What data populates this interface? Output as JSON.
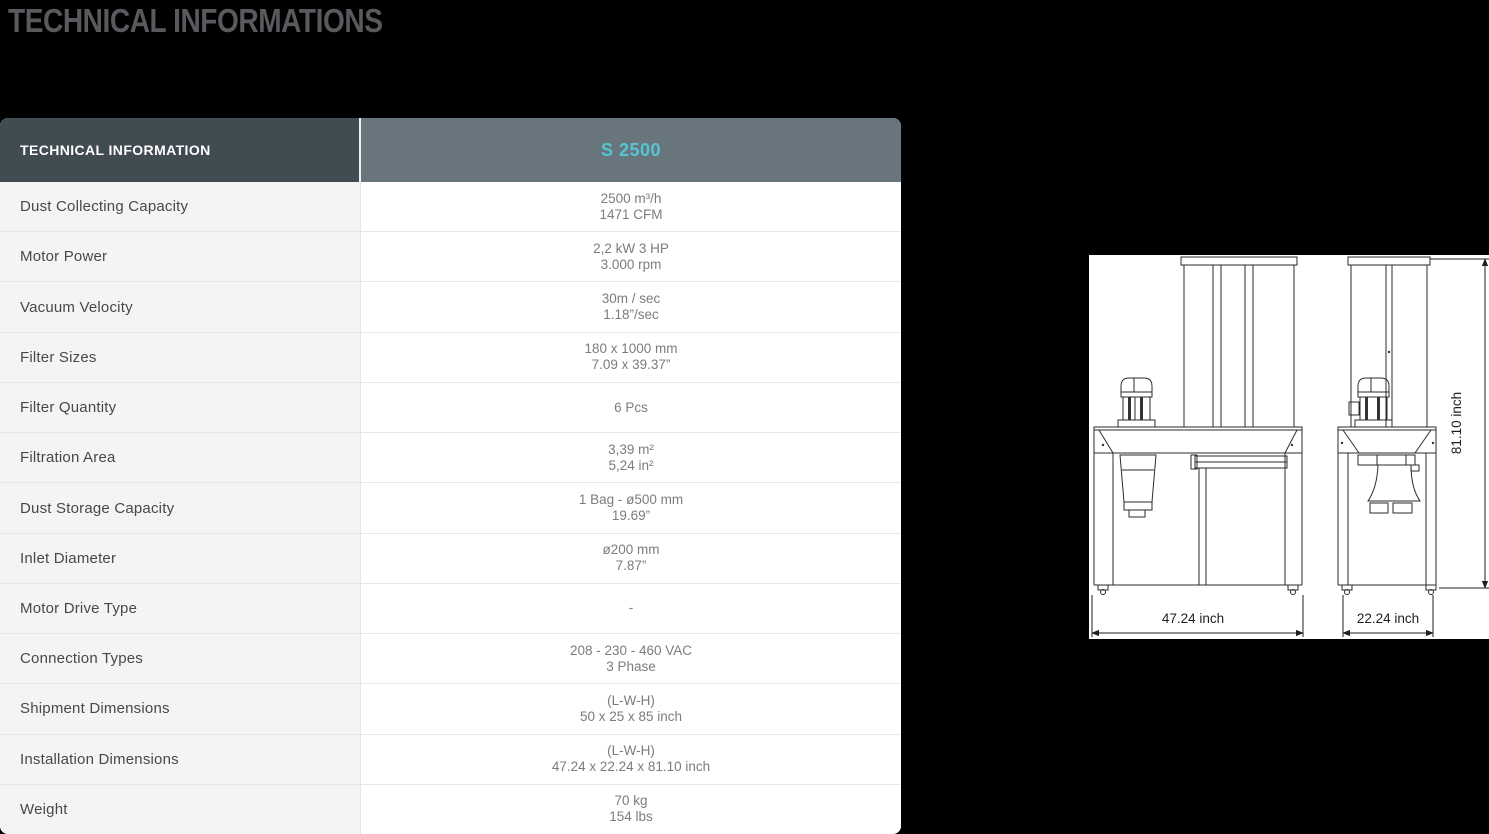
{
  "page": {
    "title": "TECHNICAL INFORMATIONS",
    "background": "#000000"
  },
  "table": {
    "header": {
      "left": "TECHNICAL INFORMATION",
      "right": "S 2500"
    },
    "rows": [
      {
        "label": "Dust Collecting Capacity",
        "value1": "2500 m³/h",
        "value2": "1471 CFM"
      },
      {
        "label": "Motor Power",
        "value1": "2,2 kW 3 HP",
        "value2": "3.000 rpm"
      },
      {
        "label": "Vacuum Velocity",
        "value1": "30m / sec",
        "value2": "1.18”/sec"
      },
      {
        "label": "Filter Sizes",
        "value1": "180 x 1000 mm",
        "value2": "7.09 x 39.37”"
      },
      {
        "label": "Filter Quantity",
        "value1": "6 Pcs",
        "value2": ""
      },
      {
        "label": "Filtration Area",
        "value1": "3,39 m²",
        "value2": "5,24 in²"
      },
      {
        "label": "Dust Storage Capacity",
        "value1": "1 Bag - ø500 mm",
        "value2": "19.69”"
      },
      {
        "label": "Inlet Diameter",
        "value1": "ø200 mm",
        "value2": "7.87”"
      },
      {
        "label": "Motor Drive Type",
        "value1": "-",
        "value2": ""
      },
      {
        "label": "Connection Types",
        "value1": "208 - 230 - 460 VAC",
        "value2": "3 Phase"
      },
      {
        "label": "Shipment Dimensions",
        "value1": "(L-W-H)",
        "value2": "50 x 25 x 85 inch"
      },
      {
        "label": "Installation Dimensions",
        "value1": "(L-W-H)",
        "value2": "47.24 x 22.24 x 81.10 inch"
      },
      {
        "label": "Weight",
        "value1": "70 kg",
        "value2": "154 lbs"
      }
    ]
  },
  "drawing": {
    "front_width_label": "47.24 inch",
    "side_width_label": "22.24 inch",
    "height_label": "81.10 inch"
  },
  "colors": {
    "header_left_bg": "#414B52",
    "header_right_bg": "#68757D",
    "accent_teal": "#57C5D1",
    "label_cell_bg": "#F4F4F5",
    "value_cell_bg": "#FFFFFF",
    "row_border": "#E6E6E8",
    "label_text": "#48484B",
    "value_text": "#7B7C80",
    "title_text": "#595A5E",
    "page_bg": "#000000",
    "drawing_bg": "#FFFFFF",
    "drawing_line": "#2B2B2B"
  }
}
